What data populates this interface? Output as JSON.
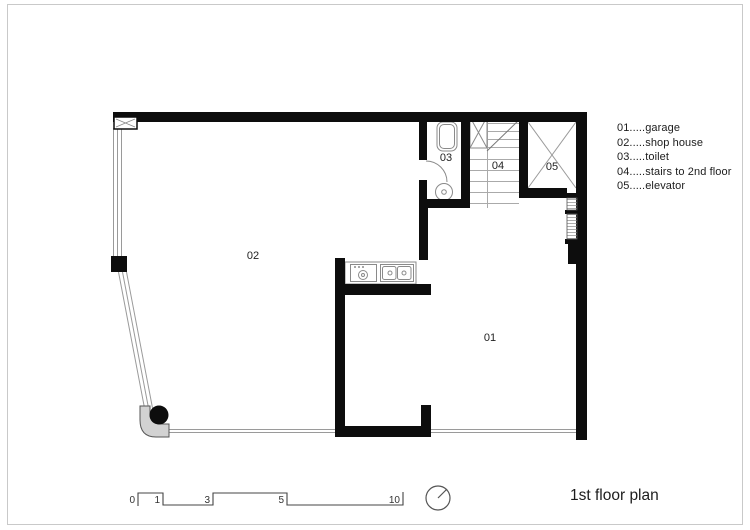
{
  "title": "1st floor plan",
  "legend": {
    "items": [
      "01.....garage",
      "02.....shop house",
      "03.....toilet",
      "04.....stairs to 2nd floor",
      "05.....elevator"
    ]
  },
  "rooms": {
    "garage": "01",
    "shop_house": "02",
    "toilet": "03",
    "stairs": "04",
    "elevator": "05"
  },
  "scale_bar": {
    "ticks": [
      "0",
      "1",
      "3",
      "5",
      "10"
    ]
  },
  "colors": {
    "wall": "#0d0d0d",
    "glass_line": "#9a9a9a",
    "fixture_line": "#8a8a8a",
    "tread_line": "#aaaaaa",
    "corner_fill": "#d2d2d2",
    "border": "#c9c9c9",
    "text": "#222222"
  }
}
